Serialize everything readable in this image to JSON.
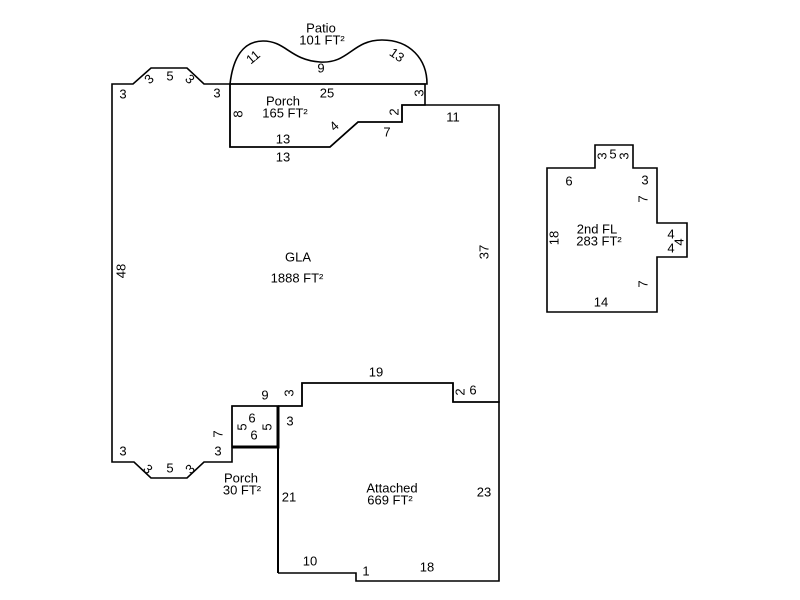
{
  "sketch": {
    "patio": {
      "label": "Patio",
      "area": "101 FT²",
      "dims": {
        "curve_left": "11",
        "curve_mid": "9",
        "curve_right": "13"
      }
    },
    "upper_porch": {
      "label": "Porch",
      "area": "165 FT²",
      "dims": {
        "top": "25",
        "right": "3",
        "left": "8",
        "step_v": "2",
        "step_h": "7",
        "diag": "4",
        "bottom_inner": "13",
        "bottom_outer": "13"
      }
    },
    "gla": {
      "label": "GLA",
      "area": "1888 FT²",
      "dims": {
        "left": "48",
        "right": "37",
        "top_right": "11",
        "top_a": "3",
        "bump_up": "3",
        "bump_top": "5",
        "bump_down": "3",
        "top_b": "3",
        "bottom_19": "19",
        "bottom_step": "3",
        "bottom_9": "9",
        "bottom_2": "2",
        "bottom_6": "6",
        "notch_left": "7",
        "bottom_a": "3",
        "zig_down": "3",
        "zig_bottom": "5",
        "zig_up": "3",
        "bottom_b": "3"
      }
    },
    "lower_porch": {
      "label": "Porch",
      "area": "30 FT²",
      "dims": {
        "top": "6",
        "left": "5",
        "right": "5",
        "bottom": "6"
      }
    },
    "garage": {
      "label": "Attached",
      "area": "669 FT²",
      "dims": {
        "top": "3",
        "left": "21",
        "right": "23",
        "bottom_left": "10",
        "step": "1",
        "bottom_right": "18"
      }
    },
    "second_floor": {
      "label": "2nd FL",
      "area": "283 FT²",
      "dims": {
        "top_left": "6",
        "bump_left": "3",
        "bump_top": "5",
        "bump_right": "3",
        "top_right": "3",
        "right_upper": "7",
        "ext_top": "4",
        "ext_right": "4",
        "ext_bottom": "4",
        "right_lower": "7",
        "bottom": "14",
        "left": "18"
      }
    },
    "colors": {
      "line": "#000000",
      "hidden_edge": "#808080"
    }
  }
}
